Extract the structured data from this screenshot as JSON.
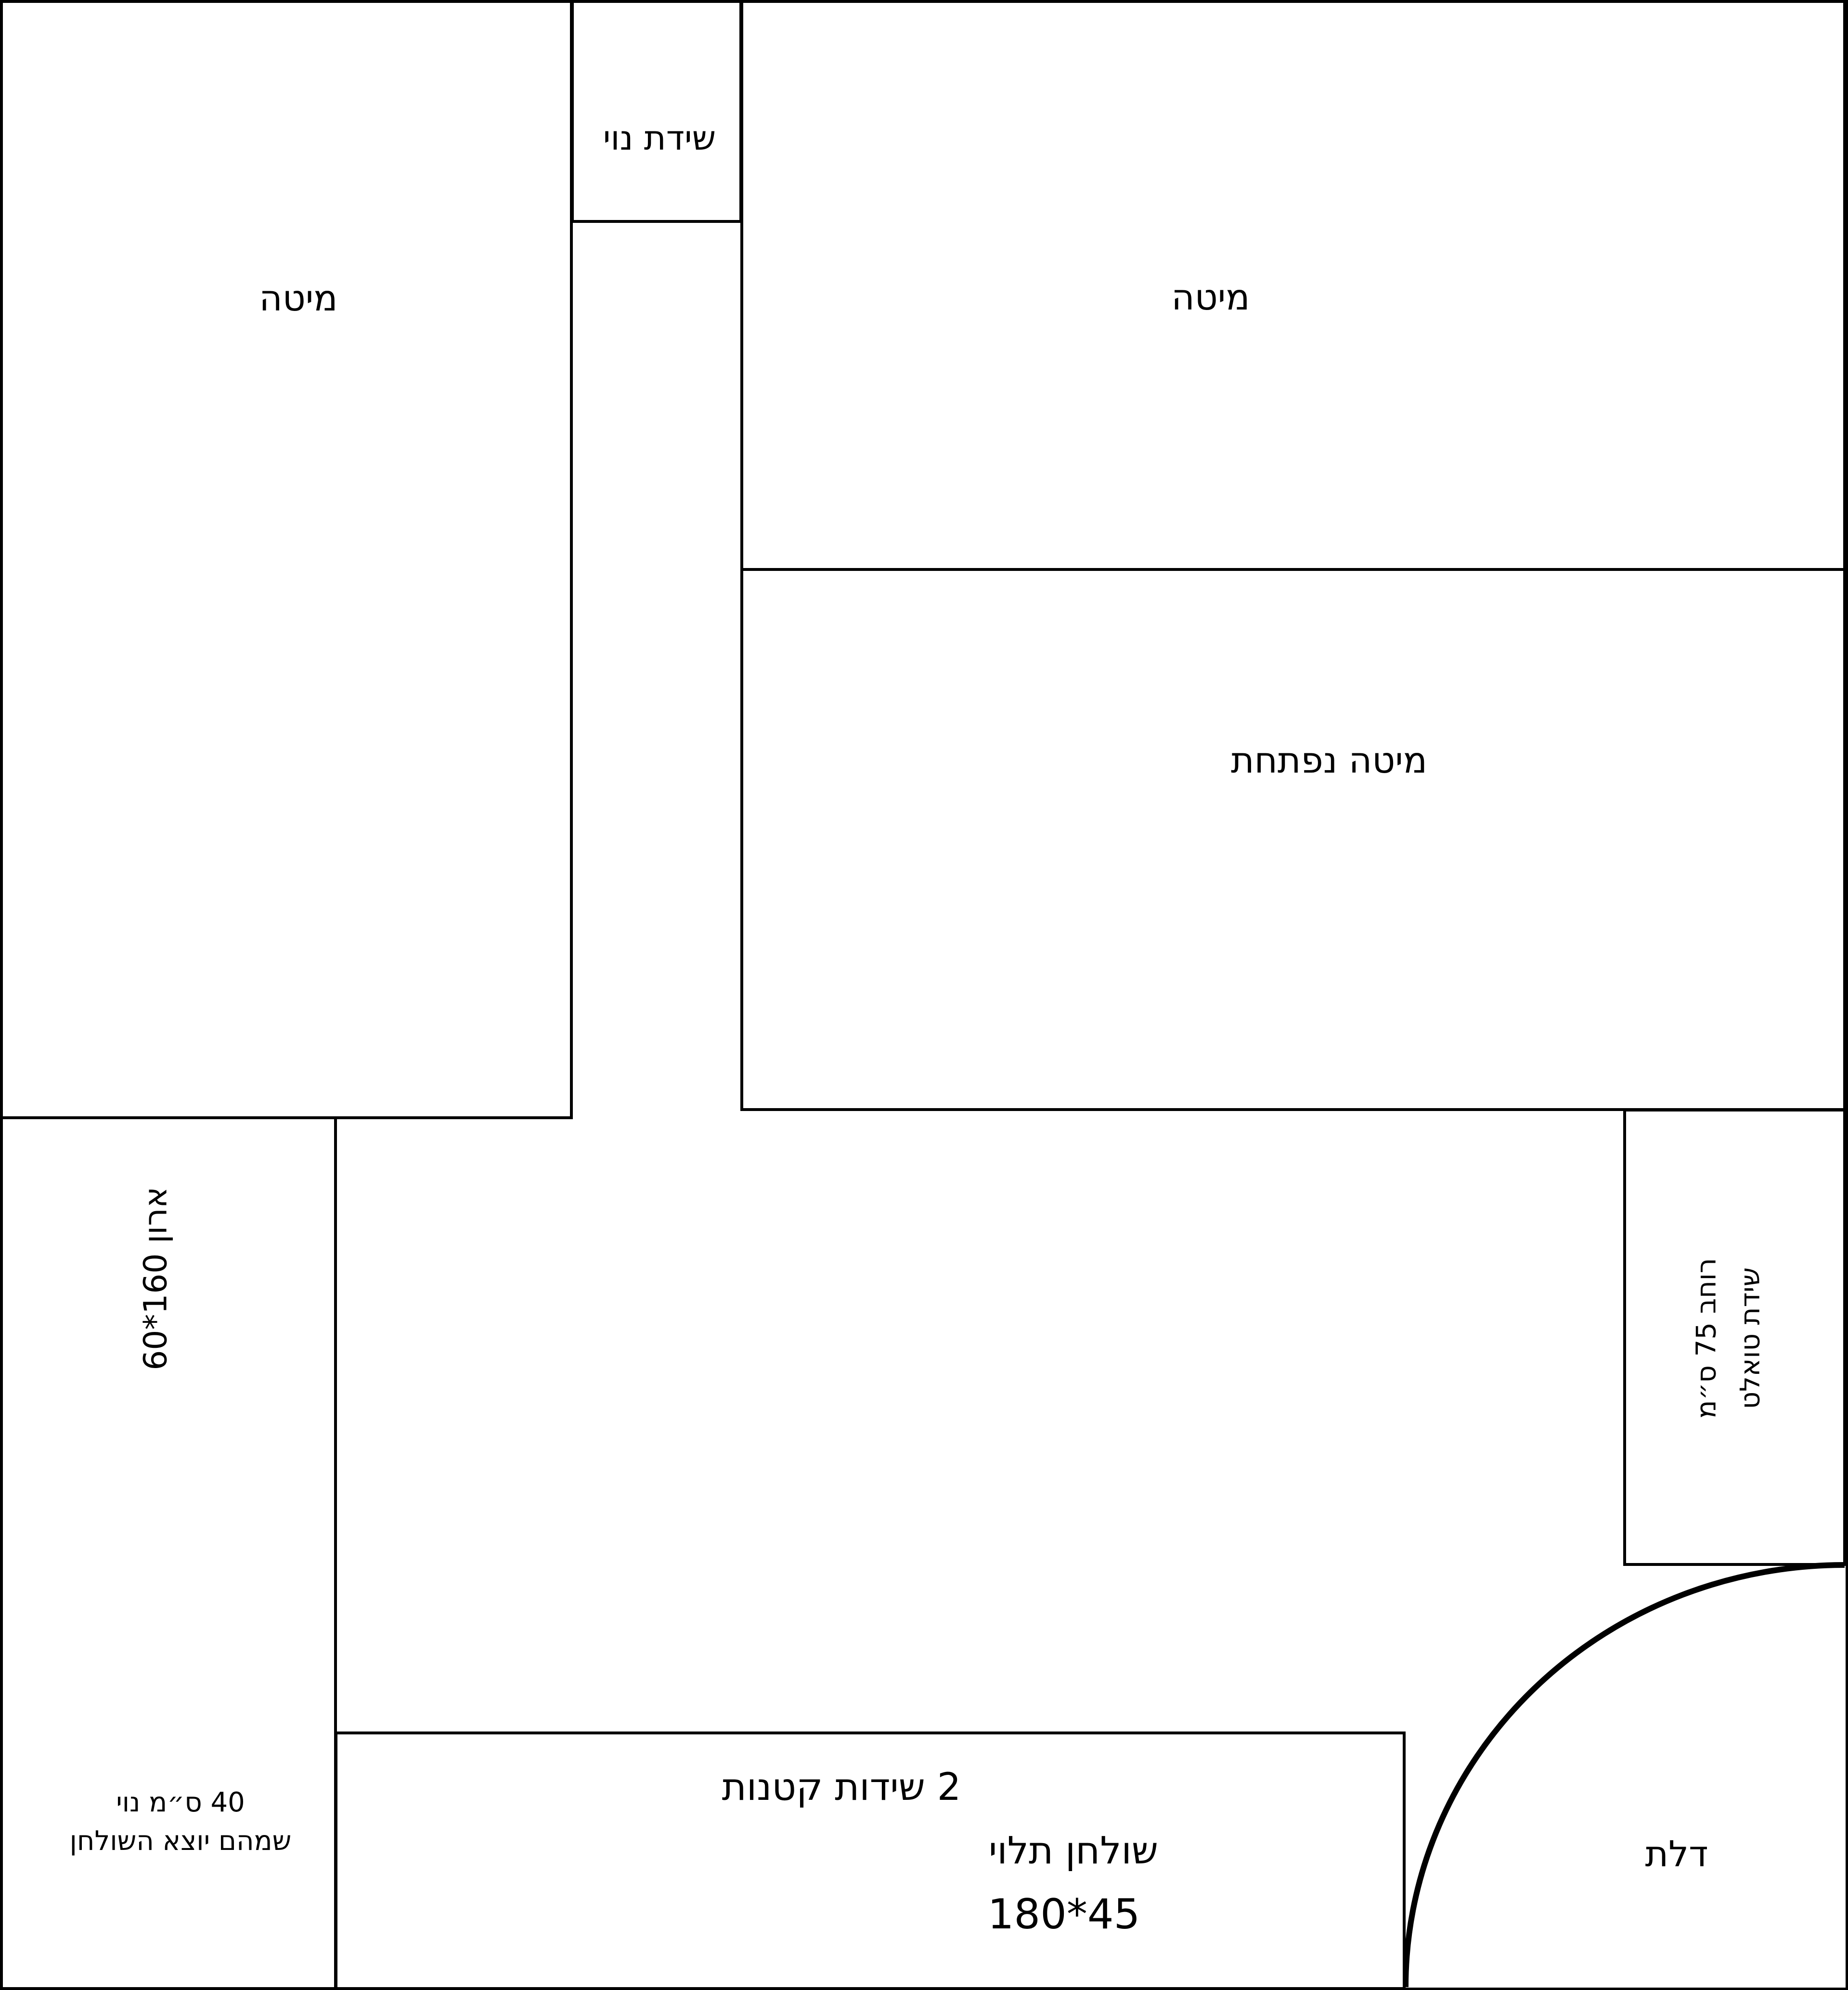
{
  "plan": {
    "type": "bedroom-furniture-floor-plan",
    "background": "#ffffff",
    "line_color": "#000000"
  },
  "furniture": {
    "bed_left": {
      "label": "מיטה"
    },
    "decor_dresser": {
      "label": "שידת נוי"
    },
    "bed_right": {
      "label": "מיטה"
    },
    "opening_bed": {
      "label": "מיטה נפתחת"
    },
    "closet": {
      "label": "ארון 160*60"
    },
    "toilet_dresser": {
      "label_line1": "שידת טואלט",
      "label_line2": "רוחב 75 ס״מ"
    },
    "small_dressers": {
      "label": "2 שידות קטנות"
    },
    "hanging_table": {
      "label": "שולחן תלוי",
      "dimensions": "180*45"
    },
    "door": {
      "label": "דלת"
    },
    "corner_note": {
      "line1": "40 ס״מ נוי",
      "line2": "שמהם יוצא השולחן"
    }
  }
}
